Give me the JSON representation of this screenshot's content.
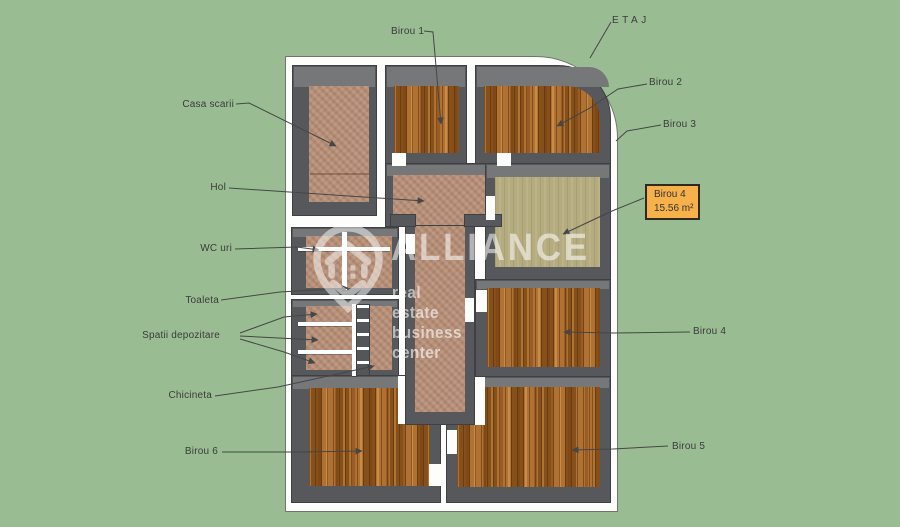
{
  "scene": {
    "floor_title": "ETAJ"
  },
  "watermark": {
    "brand": "ALLIANCE",
    "tagline": "real estate business center",
    "logo_icon": "house-pin-icon"
  },
  "highlight_box": {
    "room": "Birou 4",
    "area": "15.56 m²"
  },
  "labels": {
    "birou_1": "Birou 1",
    "birou_2": "Birou 2",
    "birou_3": "Birou 3",
    "birou_4": "Birou 4",
    "birou_5": "Birou 5",
    "birou_6": "Birou 6",
    "casa_scarii": "Casa scarii",
    "hol": "Hol",
    "wc_uri": "WC uri",
    "toaleta": "Toaleta",
    "spatii_depozitare": "Spatii depozitare",
    "chicineta": "Chicineta"
  },
  "colors": {
    "background": "#9abc92",
    "wall": "#57585b",
    "wall_top_face": "#767779",
    "building_white": "#fdfdfc",
    "wood_floor": "#a26120",
    "tile_floor": "#ba927a",
    "olive_floor": "#b4ab7f",
    "highlight_box_fill": "#f6b14b",
    "label_text": "#3b3b3b",
    "watermark_white": "rgba(255,255,255,0.55)"
  }
}
